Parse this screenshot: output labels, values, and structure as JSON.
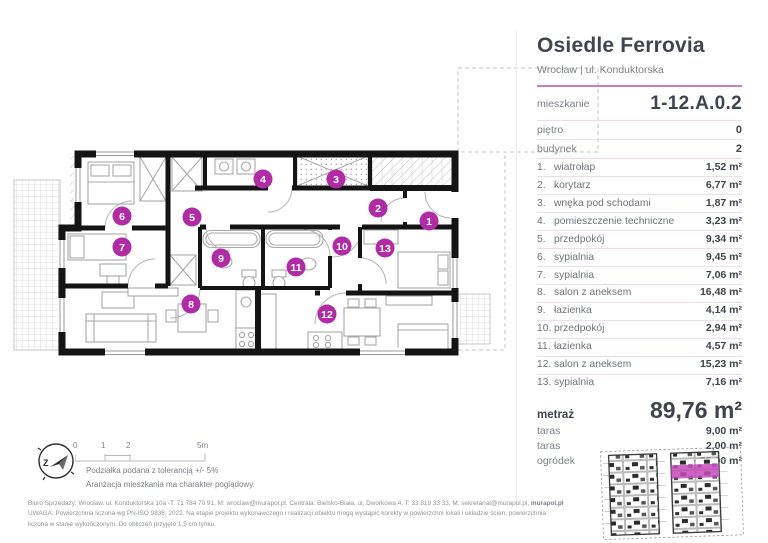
{
  "header": {
    "title": "Osiedle Ferrovia",
    "subtitle": "Wrocław | ul. Konduktorska"
  },
  "unit": {
    "mieszkanie": {
      "label": "mieszkanie",
      "value": "1-12.A.0.2"
    },
    "pietro": {
      "label": "piętro",
      "value": "0"
    },
    "budynek": {
      "label": "budynek",
      "value": "2"
    }
  },
  "rooms": [
    {
      "no": "1.",
      "name": "wiatrołap",
      "area": "1,52 m²"
    },
    {
      "no": "2.",
      "name": "korytarz",
      "area": "6,77 m²"
    },
    {
      "no": "3.",
      "name": "wnęka pod schodami",
      "area": "1,87 m²"
    },
    {
      "no": "4.",
      "name": "pomieszczenie techniczne",
      "area": "3,23 m²"
    },
    {
      "no": "5.",
      "name": "przedpokój",
      "area": "9,34 m²"
    },
    {
      "no": "6.",
      "name": "sypialnia",
      "area": "9,45 m²"
    },
    {
      "no": "7.",
      "name": "sypialnia",
      "area": "7,06 m²"
    },
    {
      "no": "8.",
      "name": "salon z aneksem",
      "area": "16,48 m²"
    },
    {
      "no": "9.",
      "name": "łazienka",
      "area": "4,14 m²"
    },
    {
      "no": "10.",
      "name": "przedpokój",
      "area": "2,94 m²"
    },
    {
      "no": "11.",
      "name": "łazienka",
      "area": "4,57 m²"
    },
    {
      "no": "12.",
      "name": "salon z aneksem",
      "area": "15,23 m²"
    },
    {
      "no": "13.",
      "name": "sypialnia",
      "area": "7,16 m²"
    }
  ],
  "totals": {
    "metraz": {
      "label": "metraż",
      "value": "89,76 m²"
    },
    "extras": [
      {
        "label": "taras",
        "value": "9,00 m²"
      },
      {
        "label": "taras",
        "value": "2,00 m²"
      },
      {
        "label": "ogródek",
        "value": "~30,90 m²"
      }
    ]
  },
  "plan": {
    "markers": [
      {
        "n": "1",
        "x": 419,
        "y": 163
      },
      {
        "n": "2",
        "x": 368,
        "y": 150
      },
      {
        "n": "3",
        "x": 326,
        "y": 121
      },
      {
        "n": "4",
        "x": 253,
        "y": 121
      },
      {
        "n": "5",
        "x": 182,
        "y": 159
      },
      {
        "n": "6",
        "x": 112,
        "y": 158
      },
      {
        "n": "7",
        "x": 112,
        "y": 189
      },
      {
        "n": "8",
        "x": 181,
        "y": 246
      },
      {
        "n": "9",
        "x": 211,
        "y": 200
      },
      {
        "n": "10",
        "x": 332,
        "y": 188
      },
      {
        "n": "11",
        "x": 286,
        "y": 209
      },
      {
        "n": "12",
        "x": 317,
        "y": 256
      },
      {
        "n": "13",
        "x": 375,
        "y": 190
      }
    ]
  },
  "scalebar": {
    "ticks": [
      "0",
      "1",
      "2",
      "5m"
    ],
    "note1": "Podziałka podana z tolerancją +/- 5%",
    "note2": "Aranżacja mieszkania ma charakter poglądowy.",
    "compass_letter": "Z"
  },
  "footer": {
    "line1": "Biuro Sprzedaży: Wrocław, ul. Konduktorska 10a -T: 71 784 70 91, M: wroclaw@murapol.pl. Centrala: Bielsko-Biała, ul. Dworkowa 4, T: 33 819 33 33, M: sekretariat@murapol.pl, ",
    "line1_bold": "murapol.pl",
    "line2": "UWAGA: Powierzchnia liczona wg PN-ISO 9836; 2022. Na etapie projektu wykonawczego i realizacji obiektu mogą wystąpić korekty w powierzchni lokali i układzie ścian, powierzchnia",
    "line3": "liczona w stanie wykończonym. Do obliczeń przyjęto 1,5 cm tynku."
  },
  "colors": {
    "accent": "#b12ba6",
    "accent_light": "#c54ab8",
    "divider": "#eedcec",
    "wall": "#141414"
  }
}
